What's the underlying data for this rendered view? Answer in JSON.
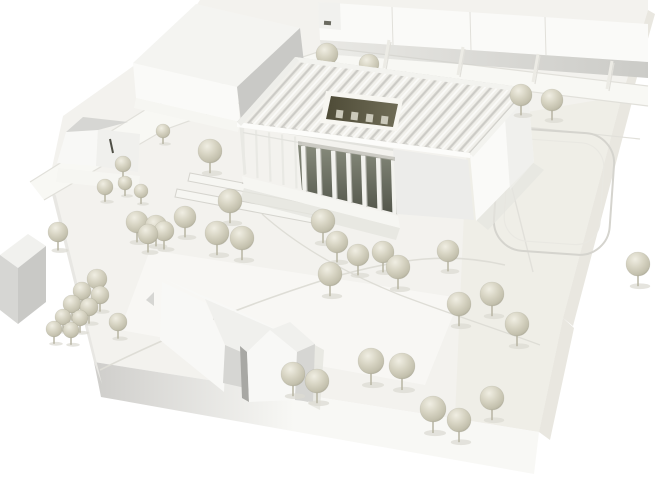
{
  "scene": {
    "kind": "architectural-model-photograph",
    "background_color": "#ffffff"
  },
  "palette": {
    "bg": "#ffffff",
    "baseTop": "#f3f2ee",
    "baseTintRight": "#eeece5",
    "plazaTint": "#f9f9f6",
    "baseFrontLight": "#f8f8f5",
    "baseFrontDark": "#cfcecb",
    "baseSideLeft": "#e8e7e3",
    "baseSideRight": "#e9e7e0",
    "roadFill": "#f8f8f4",
    "roadEdge": "#e1e0da",
    "grooveLine": "#d5d4ce",
    "grooveLight": "#e9e8e2",
    "pathLine": "#deddd6",
    "whiteFace": "#fafaf8",
    "lightFace": "#f1f1ee",
    "topFace": "#f4f4f1",
    "grayFace": "#c9c9c6",
    "shadowBand": "#cbcbc7",
    "tickDark": "#6a6a60",
    "wallWhite": "#eceb e5",
    "ribBase": "#d8d7d2",
    "ribStripe": "#f1f0eb",
    "ribHighlight": "#ffffff",
    "ribLine": "#c8c7c2",
    "fasciaSW": "#fcfcfa",
    "fasciaSE": "#f3f3ef",
    "fasciaNW": "#eeeeea",
    "soffit": "#a9a9a1",
    "glazeTop": "#878b7c",
    "glazeBottom": "#52554a",
    "column": "#f2f2ee",
    "columnShadow": "#b4b4ad",
    "post": "#e9e9e4",
    "beam": "#e2e2dd",
    "frontWall": "#ececea",
    "rightWallA": "#fafaf8",
    "rightWallB": "#eeeeea",
    "plinth": "#f6f6f2",
    "groundShadow": "#e5e5df",
    "skylightDark1": "#4e4b37",
    "skylightDark2": "#6f6c56",
    "skylightRim": "#f7f6f1",
    "tooth": "#cbc9ba",
    "treeLight": "#f0eee3",
    "treeMid": "#d7d4c3",
    "treeDark": "#c3c0ad",
    "treeEdge": "#a8a593",
    "stem": "#b7b4a2",
    "treeShadow": "#dcdbd3",
    "houseBright": "#f8f8f6",
    "houseMid": "#f0f0ed",
    "houseGray": "#d6d6d3",
    "houseDark": "#a8a8a4",
    "slit": "#4f4f46",
    "pin": "#cfcec8",
    "pinHead": "#dad8cc"
  },
  "roof": {
    "n": [
      295,
      57
    ],
    "e": [
      528,
      88
    ],
    "w": [
      237,
      122
    ],
    "rib_count": 21
  },
  "colonnade": {
    "x0": 303,
    "step": 15,
    "count": 7,
    "top_y0": 146,
    "top_slope": 0.155,
    "bot_y0": 191,
    "bot_slope": 0.252,
    "width": 4.2
  },
  "pergola": {
    "x0": 243,
    "step": 13,
    "count": 5,
    "top_y0": 127.5,
    "top_slope": 0.163,
    "bot_y0": 174,
    "bot_slope": 0.262,
    "width": 2.2
  },
  "divider_walls": [
    [
      389,
      40
    ],
    [
      463,
      47
    ],
    [
      538,
      54
    ],
    [
      612,
      61
    ]
  ],
  "trees_behind": [
    [
      327,
      54,
      11
    ],
    [
      369,
      64,
      10
    ]
  ],
  "trees": [
    [
      521,
      95,
      11
    ],
    [
      552,
      100,
      11
    ],
    [
      163,
      131,
      7
    ],
    [
      123,
      164,
      8
    ],
    [
      210,
      151,
      12
    ],
    [
      105,
      187,
      8
    ],
    [
      125,
      183,
      7
    ],
    [
      141,
      191,
      7
    ],
    [
      230,
      201,
      12
    ],
    [
      137,
      222,
      11
    ],
    [
      156,
      226,
      11
    ],
    [
      185,
      217,
      11
    ],
    [
      148,
      234,
      10
    ],
    [
      164,
      231,
      10
    ],
    [
      58,
      232,
      10
    ],
    [
      217,
      233,
      12
    ],
    [
      242,
      238,
      12
    ],
    [
      323,
      221,
      12
    ],
    [
      337,
      242,
      11
    ],
    [
      358,
      255,
      11
    ],
    [
      383,
      252,
      11
    ],
    [
      330,
      274,
      12
    ],
    [
      398,
      267,
      12
    ],
    [
      448,
      251,
      11
    ],
    [
      459,
      304,
      12
    ],
    [
      492,
      294,
      12
    ],
    [
      517,
      324,
      12
    ],
    [
      638,
      264,
      12
    ],
    [
      97,
      279,
      10
    ],
    [
      82,
      291,
      9
    ],
    [
      100,
      295,
      9
    ],
    [
      72,
      304,
      9
    ],
    [
      89,
      307,
      9
    ],
    [
      63,
      317,
      8
    ],
    [
      80,
      318,
      8
    ],
    [
      54,
      329,
      8
    ],
    [
      71,
      330,
      8
    ],
    [
      118,
      322,
      9
    ],
    [
      293,
      374,
      12
    ],
    [
      317,
      381,
      12
    ],
    [
      371,
      361,
      13
    ],
    [
      402,
      366,
      13
    ],
    [
      433,
      409,
      13
    ],
    [
      459,
      420,
      12
    ],
    [
      492,
      398,
      12
    ]
  ]
}
